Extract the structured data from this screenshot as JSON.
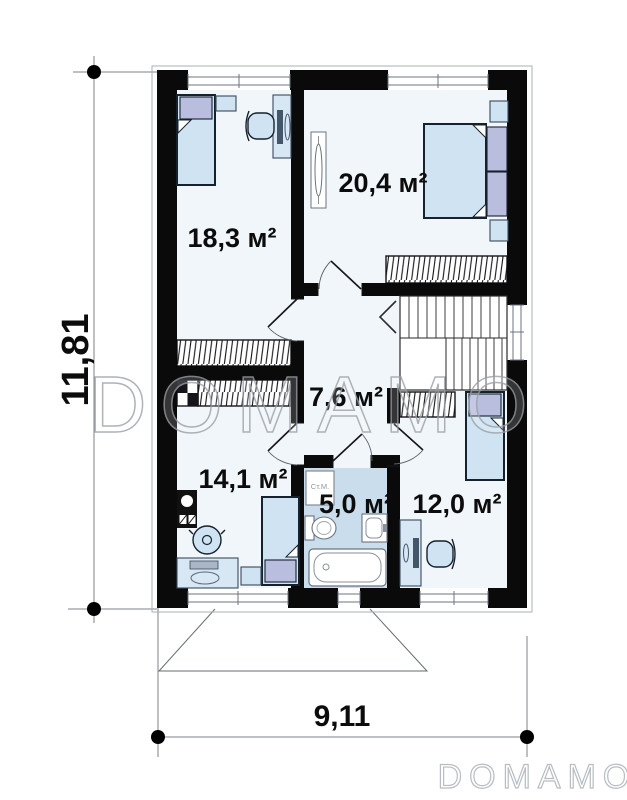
{
  "plan": {
    "rooms": [
      {
        "name": "bedroom-top-left",
        "area": "18,3 м²"
      },
      {
        "name": "bedroom-top-right",
        "area": "20,4 м²"
      },
      {
        "name": "hall",
        "area": "7,6 м²"
      },
      {
        "name": "kitchen-room",
        "area": "14,1 м²"
      },
      {
        "name": "bathroom",
        "area": "5,0 м²"
      },
      {
        "name": "bedroom-bottom-right",
        "area": "12,0 м²"
      }
    ],
    "appliance_labels": {
      "washing_machine": "Ст.М."
    },
    "dimensions": {
      "height": "11,81",
      "width": "9,11"
    }
  },
  "watermark": {
    "center": "DOMAMO",
    "logo": "DOMAMO"
  },
  "colors": {
    "wall": "#0a0a0a",
    "floor": "#f1f6fa",
    "bathroom_floor": "#cadded",
    "furniture_fill": "#cfe3f2",
    "pillow_fill": "#b9bedf",
    "watermark_gray": "#9ba1a8"
  }
}
